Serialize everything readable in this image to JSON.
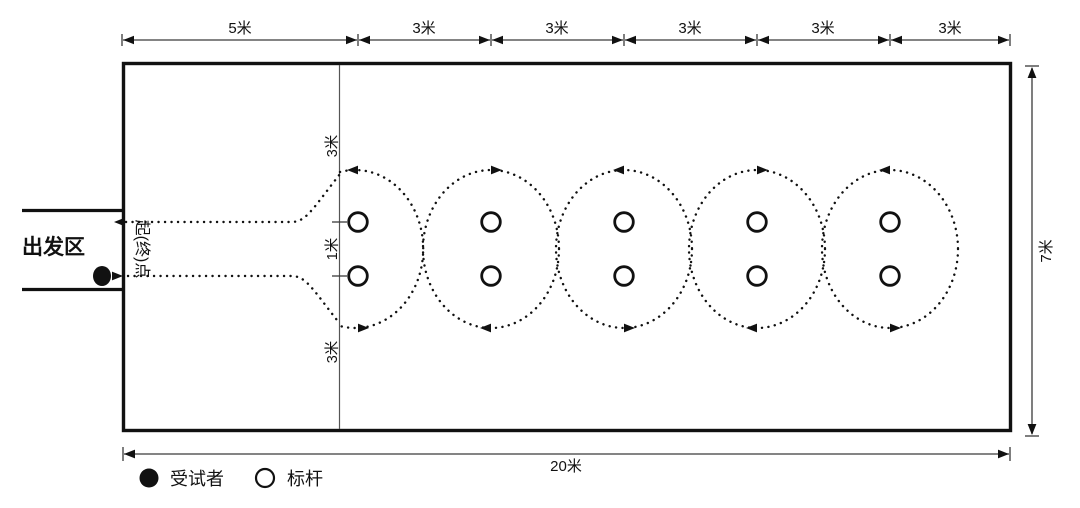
{
  "colors": {
    "ink": "#111111",
    "thin_line": "#3a3a3a",
    "background": "#ffffff"
  },
  "top_dimensions": {
    "labels": [
      "5米",
      "3米",
      "3米",
      "3米",
      "3米",
      "3米"
    ]
  },
  "start_zone": {
    "area_label": "出发区",
    "point_label": "起(终)点",
    "subject_marker": "filled-circle-icon"
  },
  "inner_dimensions": {
    "top": "3米",
    "middle": "1米",
    "bottom": "3米"
  },
  "right_dimension": {
    "label": "7米"
  },
  "bottom_dimension": {
    "label": "20米"
  },
  "legend": {
    "items": [
      {
        "icon": "filled-circle-icon",
        "label": "受试者"
      },
      {
        "icon": "open-circle-icon",
        "label": "标杆"
      }
    ]
  }
}
